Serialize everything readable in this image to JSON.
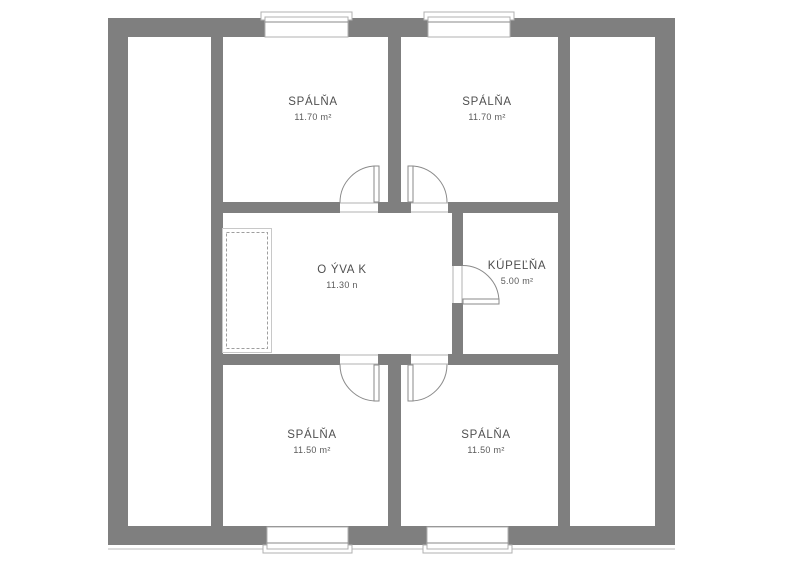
{
  "colors": {
    "wall": "#7f7f7f",
    "thin_line": "#b0b0b0",
    "label_text": "#4f4f4f"
  },
  "rooms": [
    {
      "id": "bedroom-top-left",
      "name": "SPÁLŇA",
      "area": "11.70 m²"
    },
    {
      "id": "bedroom-top-right",
      "name": "SPÁLŇA",
      "area": "11.70 m²"
    },
    {
      "id": "living-room",
      "name": "O ÝVA K",
      "area": "11.30 n"
    },
    {
      "id": "bathroom",
      "name": "KÚPEĽŇA",
      "area": "5.00 m²"
    },
    {
      "id": "bedroom-bottom-left",
      "name": "SPÁLŇA",
      "area": "11.50 m²"
    },
    {
      "id": "bedroom-bottom-right",
      "name": "SPÁLŇA",
      "area": "11.50 m²"
    }
  ]
}
